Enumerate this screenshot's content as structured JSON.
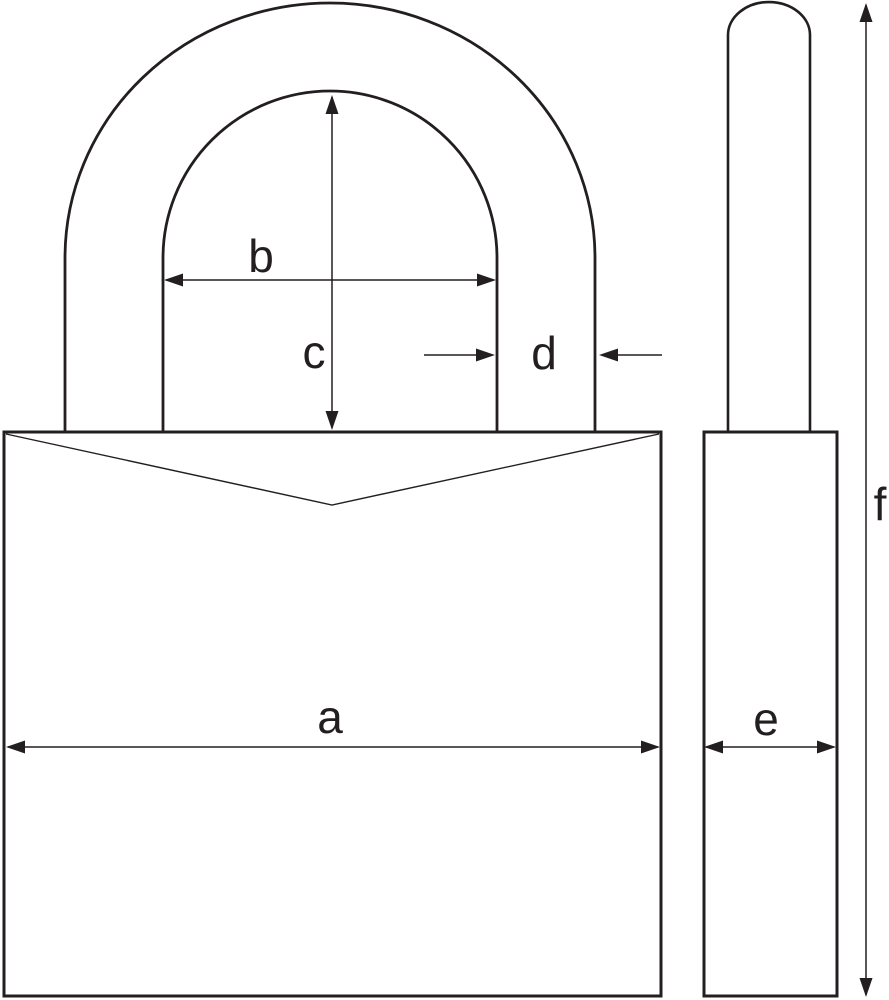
{
  "diagram": {
    "background_color": "#ffffff",
    "line_color": "#231f20",
    "dimension_labels": {
      "a": "a",
      "b": "b",
      "c": "c",
      "d": "d",
      "e": "e",
      "f": "f"
    }
  }
}
